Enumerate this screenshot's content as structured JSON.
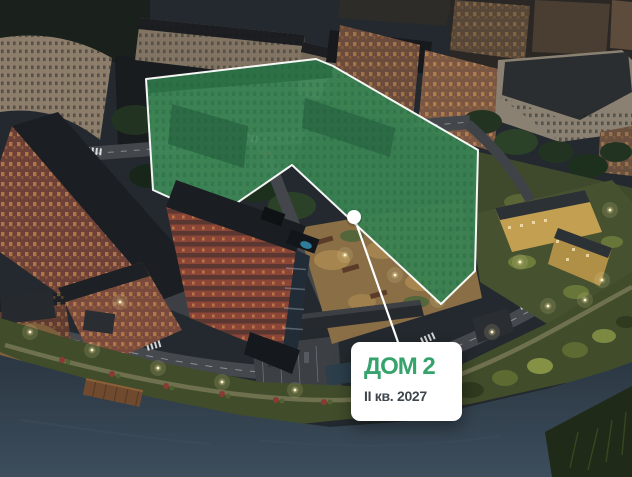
{
  "scene": {
    "description": "Night-time aerial 3D render of a riverside residential complex; one U-shaped building is highlighted in translucent green with a white outline, a white marker dot and a leader line pointing to a white info card",
    "colors": {
      "highlight_green": "#3f8a59",
      "highlight_outline": "#ffffff",
      "water": "#2e3b45",
      "accent_text_green": "#35a36b",
      "subtitle_text": "#3d464c",
      "card_background": "#ffffff"
    }
  },
  "card": {
    "title": "ДОМ 2",
    "subtitle": "II кв. 2027"
  }
}
